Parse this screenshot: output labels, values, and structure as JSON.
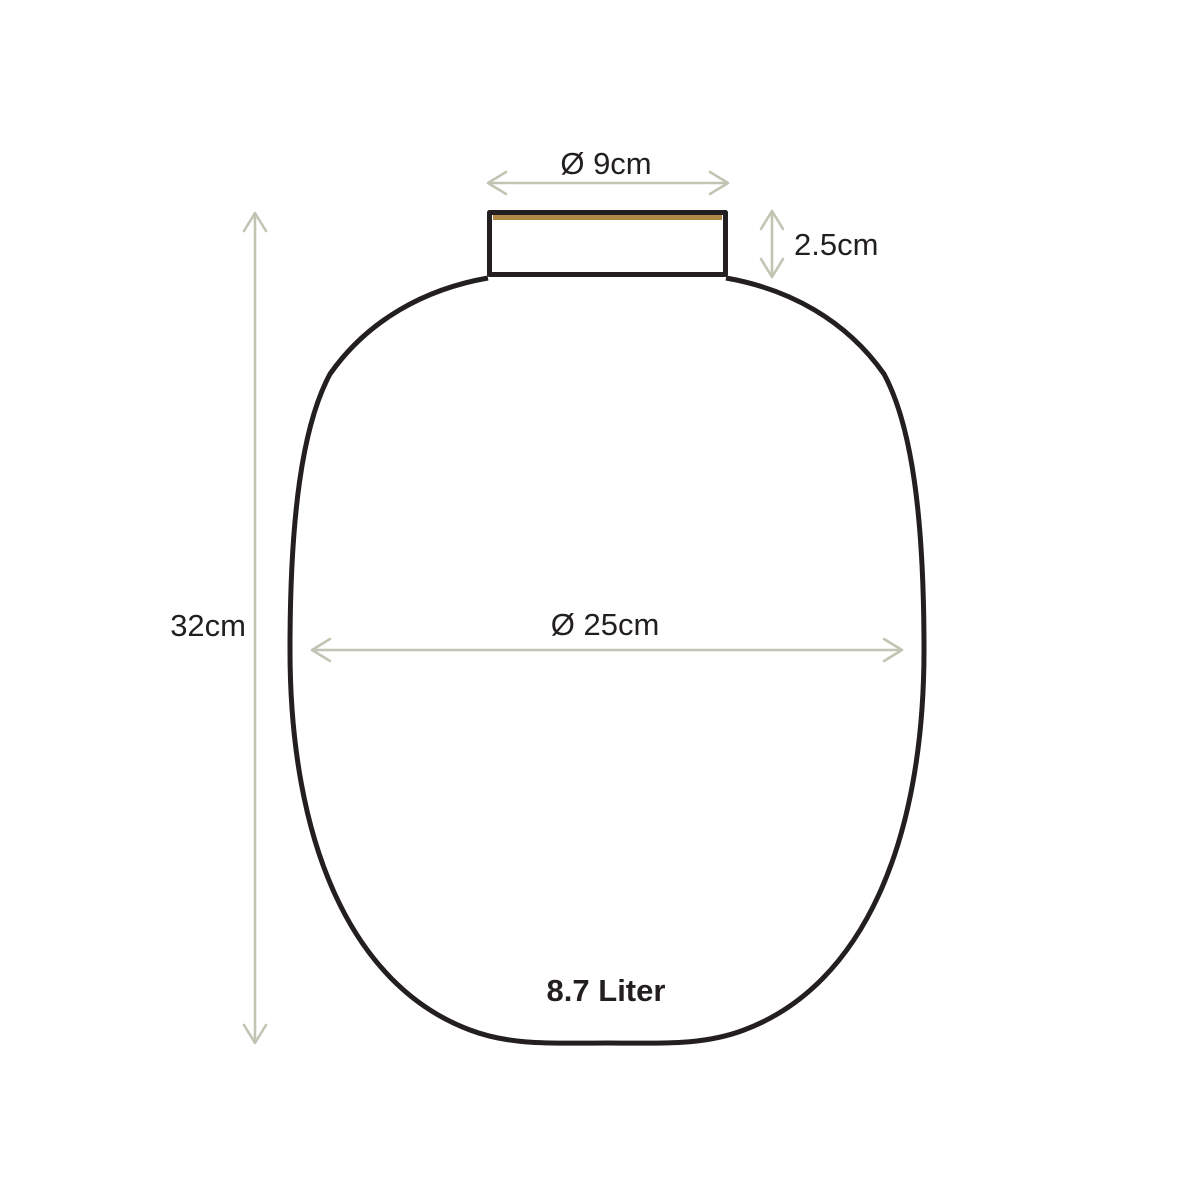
{
  "diagram": {
    "title": "Vase dimension drawing",
    "labels": {
      "top_diameter": "Ø 9cm",
      "neck_height": "2.5cm",
      "total_height": "32cm",
      "body_diameter": "Ø 25cm",
      "capacity": "8.7 Liter"
    }
  },
  "colors": {
    "background": "#ffffff",
    "outline": "#231f20",
    "dimension_arrow": "#c3c4b4",
    "gold_rim": "#b08a44",
    "text": "#231f20"
  }
}
